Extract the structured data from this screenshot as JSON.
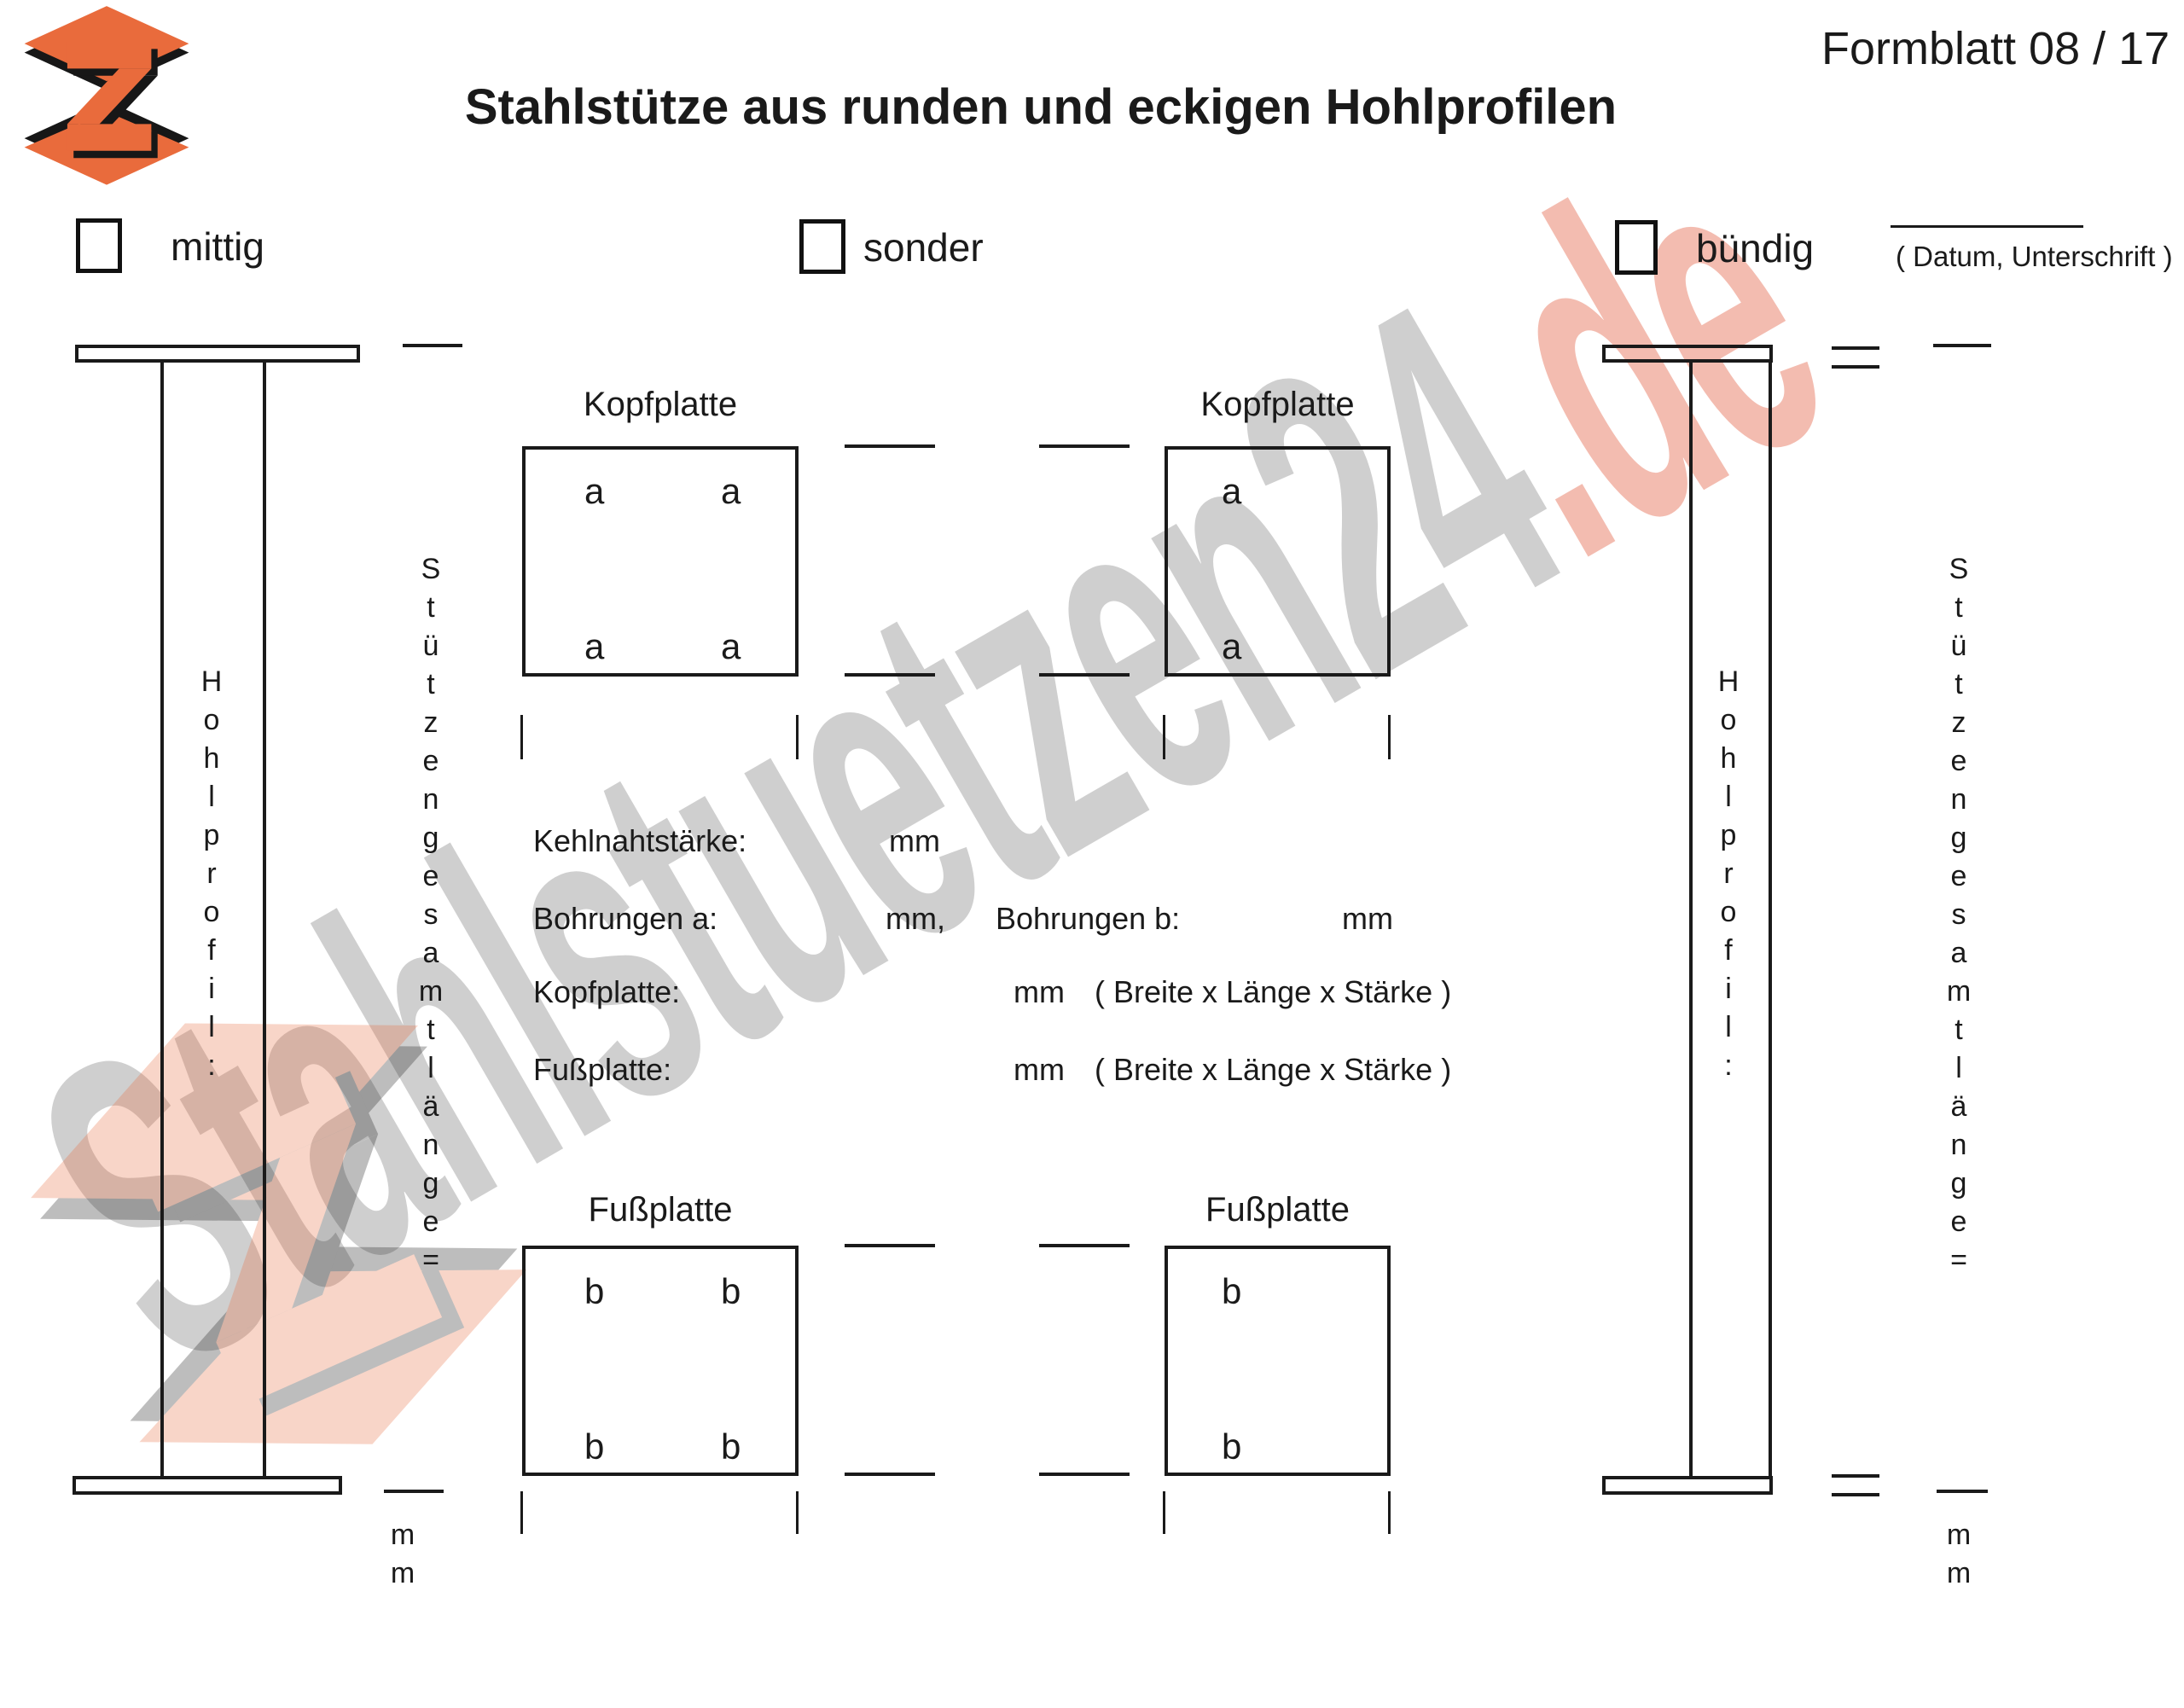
{
  "header": {
    "form_number": "Formblatt 08 / 17",
    "title": "Stahlstütze aus runden und eckigen Hohlprofilen"
  },
  "options": {
    "mittig": "mittig",
    "sonder": "sonder",
    "buendig": "bündig"
  },
  "signature": {
    "caption": "( Datum, Unterschrift )"
  },
  "watermark": {
    "text_main": "Stahlstuetzen24",
    "text_suffix": ".de",
    "gray_color": "#a8a8a8",
    "accent_color": "#e2583a"
  },
  "logo": {
    "name": "stahlstuetzen-logo",
    "orange": "#e96b3c",
    "black": "#171717"
  },
  "columns": {
    "left": {
      "profile_label": "Hohlprofil:",
      "length_label": "Stützengesamtlänge=",
      "length_unit": "mm"
    },
    "right": {
      "profile_label": "Hohlprofil:",
      "length_label": "Stützengesamtlänge=",
      "length_unit": "mm"
    }
  },
  "plates": {
    "kopf_left": {
      "title": "Kopfplatte",
      "holes": [
        "a",
        "a",
        "a",
        "a"
      ]
    },
    "kopf_right": {
      "title": "Kopfplatte",
      "holes": [
        "a",
        "a"
      ]
    },
    "fuss_left": {
      "title": "Fußplatte",
      "holes": [
        "b",
        "b",
        "b",
        "b"
      ]
    },
    "fuss_right": {
      "title": "Fußplatte",
      "holes": [
        "b",
        "b"
      ]
    }
  },
  "fields": {
    "kehlnaht": {
      "label": "Kehlnahtstärke:",
      "unit": "mm"
    },
    "bohrungen_a": {
      "label": "Bohrungen a:",
      "unit": "mm,"
    },
    "bohrungen_b": {
      "label": "Bohrungen b:",
      "unit": "mm"
    },
    "kopfplatte": {
      "label": "Kopfplatte:",
      "unit": "mm",
      "hint": "( Breite x Länge x Stärke )"
    },
    "fussplatte": {
      "label": "Fußplatte:",
      "unit": "mm",
      "hint": "( Breite x Länge x Stärke )"
    }
  }
}
